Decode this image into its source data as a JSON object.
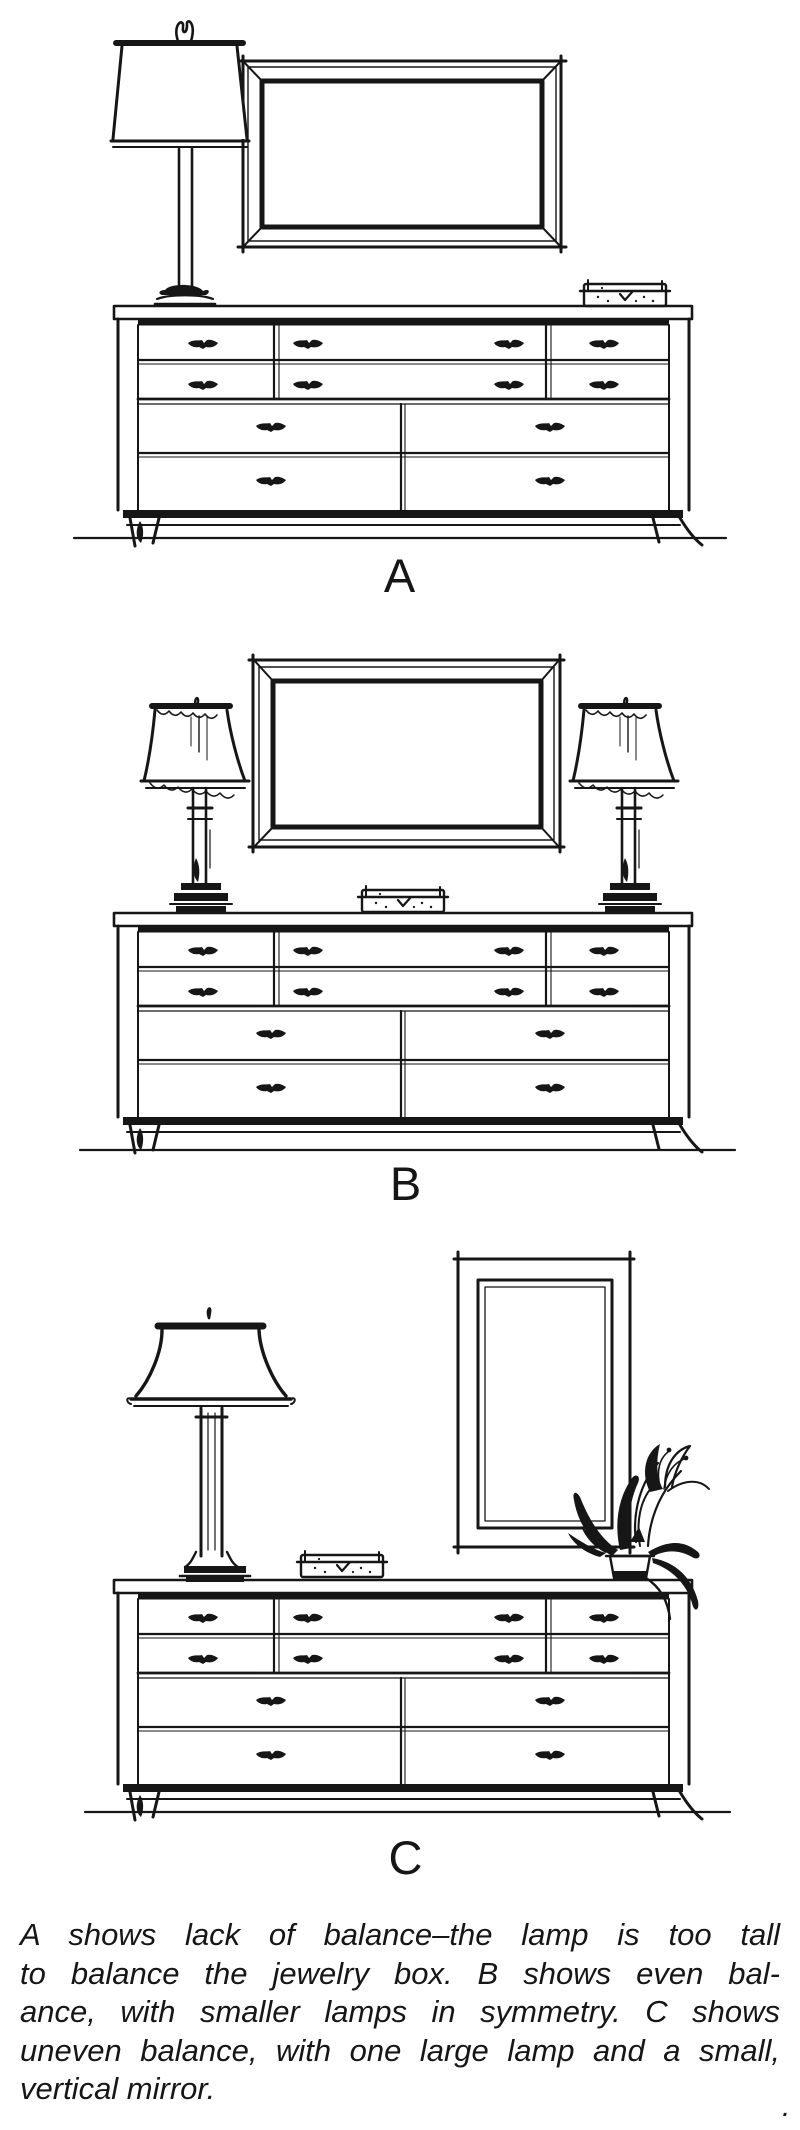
{
  "page": {
    "background": "#ffffff",
    "ink_color": "#161616",
    "corner_mark": "."
  },
  "figure": {
    "panels": [
      {
        "label": "A",
        "items": [
          "tall-table-lamp",
          "wide-horizontal-mirror",
          "jewelry-box",
          "nine-drawer-dresser",
          "ground-line"
        ]
      },
      {
        "label": "B",
        "items": [
          "small-table-lamp-left",
          "rectangular-mirror",
          "jewelry-box",
          "small-table-lamp-right",
          "nine-drawer-dresser",
          "ground-line"
        ]
      },
      {
        "label": "C",
        "items": [
          "large-table-lamp",
          "jewelry-box",
          "small-vertical-mirror",
          "potted-lily-plant",
          "nine-drawer-dresser",
          "ground-line"
        ]
      }
    ],
    "caption": {
      "lines": [
        "A shows lack of balance–the lamp is too tall",
        "to balance the jewelry box. B  shows even bal-",
        "ance, with smaller lamps in symmetry. C  shows",
        "uneven balance, with one large lamp and a small,",
        "vertical mirror."
      ]
    }
  }
}
